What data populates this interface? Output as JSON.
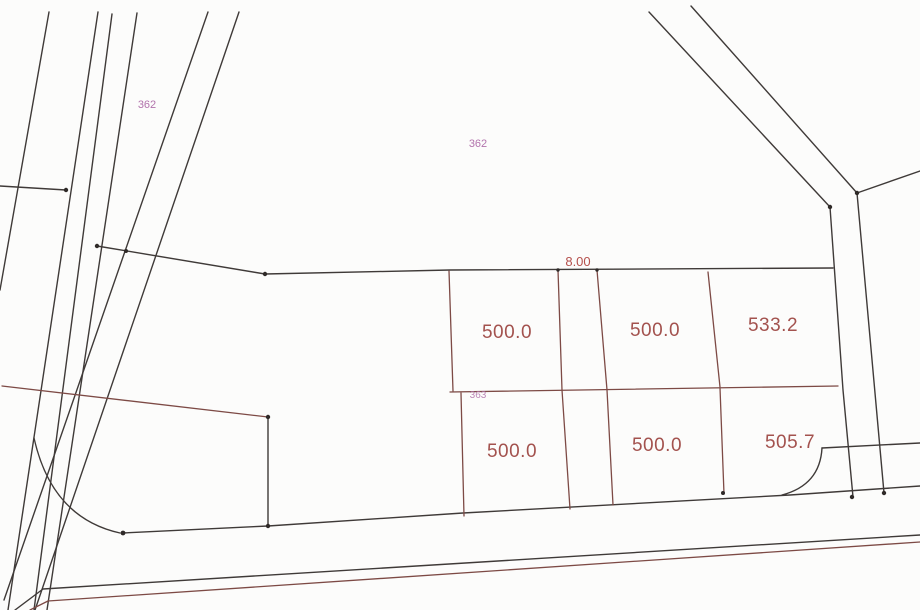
{
  "plan": {
    "background_color": "#fcfcfb",
    "line_color_black": "#3f3a38",
    "line_color_red": "#7d4a45",
    "label_color_area": "#a3524e",
    "label_color_zone": "#b273ac",
    "label_color_dimension": "#b5504c",
    "zone_labels": [
      {
        "text": "362"
      },
      {
        "text": "362"
      },
      {
        "text": "363"
      }
    ],
    "dimension": {
      "text": "8.00"
    },
    "parcels": [
      {
        "area": "500.0"
      },
      {
        "area": "500.0"
      },
      {
        "area": "533.2"
      },
      {
        "area": "500.0"
      },
      {
        "area": "500.0"
      },
      {
        "area": "505.7"
      }
    ]
  }
}
